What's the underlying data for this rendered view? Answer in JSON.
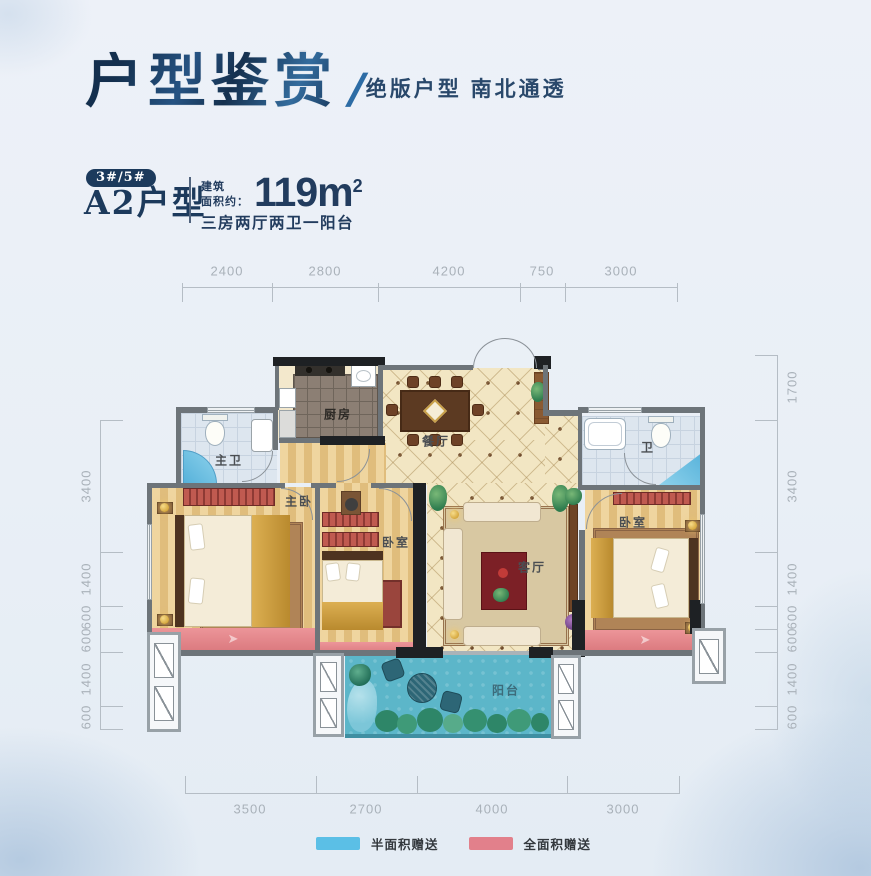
{
  "header": {
    "title": "户型鉴赏",
    "slash": "/",
    "subtitle": "绝版户型 南北通透"
  },
  "unit": {
    "badge": "3#/5#",
    "name": "A2户型",
    "area_label_line1": "建筑",
    "area_label_line2": "面积约：",
    "area_value": "119m",
    "area_exponent": "2",
    "layout_desc": "三房两厅两卫一阳台"
  },
  "dimensions": {
    "top": [
      "2400",
      "2800",
      "4200",
      "750",
      "3000"
    ],
    "bottom": [
      "3500",
      "2700",
      "4000",
      "3000"
    ],
    "left": [
      "3400",
      "1400",
      "600",
      "600",
      "1400",
      "600"
    ],
    "right": [
      "1700",
      "3400",
      "1400",
      "600",
      "600",
      "1400",
      "600"
    ]
  },
  "rooms": {
    "master_bath": "主卫",
    "kitchen": "厨房",
    "dining": "餐厅",
    "bath": "卫",
    "master_bedroom": "主卧",
    "bedroom_2": "卧室",
    "living_room": "客厅",
    "bedroom_3": "卧室",
    "balcony": "阳台"
  },
  "legend": [
    {
      "label": "半面积赠送",
      "color": "#5bbfe6"
    },
    {
      "label": "全面积赠送",
      "color": "#e2808b"
    }
  ],
  "colors": {
    "navy": "#1c3a5c",
    "dim_text": "#a9b1b9",
    "wall": "#6d7479",
    "wood": "#e9c88d",
    "tile": "#f2e6c3",
    "balcony": "#5cb6c9",
    "gift_red": "#e58a8d",
    "gift_blue": "#5bbfe6"
  }
}
